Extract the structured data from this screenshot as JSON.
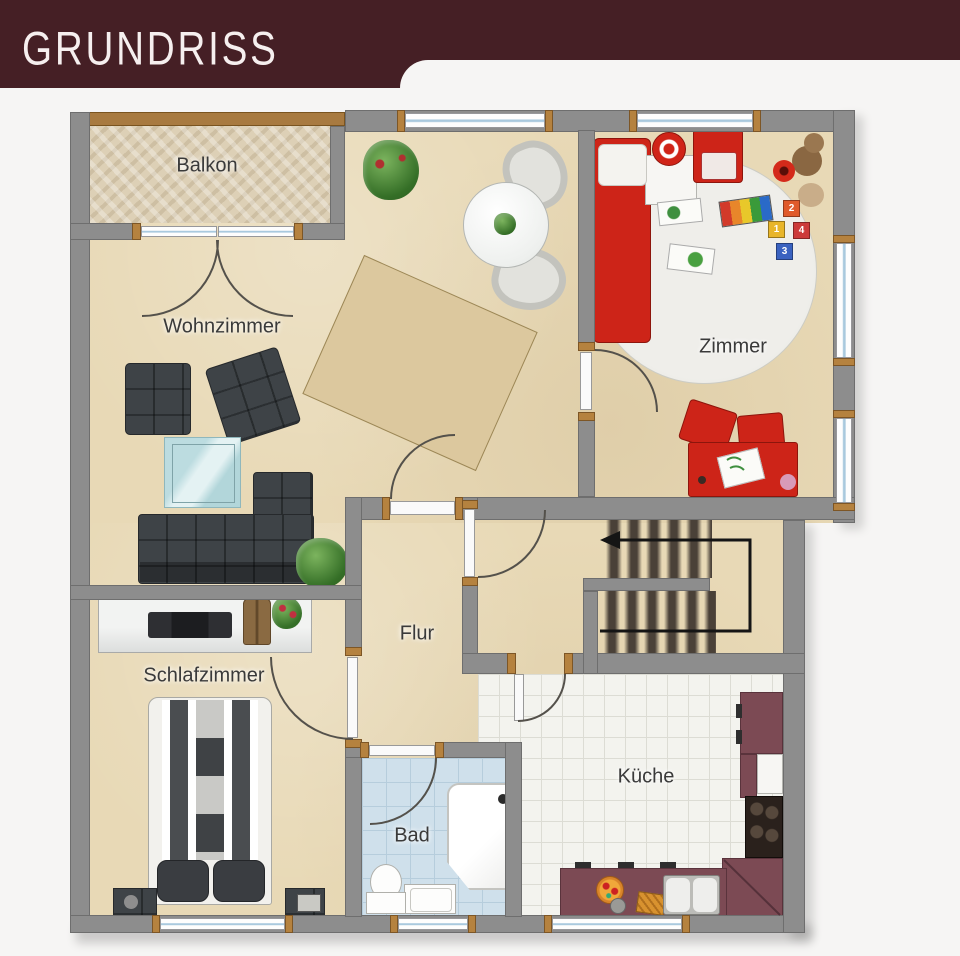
{
  "header": {
    "title": "GRUNDRISS"
  },
  "plan": {
    "rooms": {
      "balkon": {
        "label": "Balkon"
      },
      "wohnzimmer": {
        "label": "Wohnzimmer"
      },
      "zimmer": {
        "label": "Zimmer",
        "toy_blocks": [
          "2",
          "1",
          "4",
          "3"
        ]
      },
      "flur": {
        "label": "Flur"
      },
      "schlafzimmer": {
        "label": "Schlafzimmer"
      },
      "bad": {
        "label": "Bad"
      },
      "kueche": {
        "label": "Küche"
      }
    },
    "stairs": {
      "direction_arrow": "up-then-left"
    },
    "colors": {
      "header_maroon": "#451f25",
      "wall_gray": "#8d8d8d",
      "floor_beige": "#e8d9b6",
      "kitchen_counter_plum": "#7c4a54",
      "accent_red_furniture": "#cd2418",
      "bath_tile_blue": "#cfe0eb",
      "wood_frame_brown": "#b5823f"
    }
  }
}
